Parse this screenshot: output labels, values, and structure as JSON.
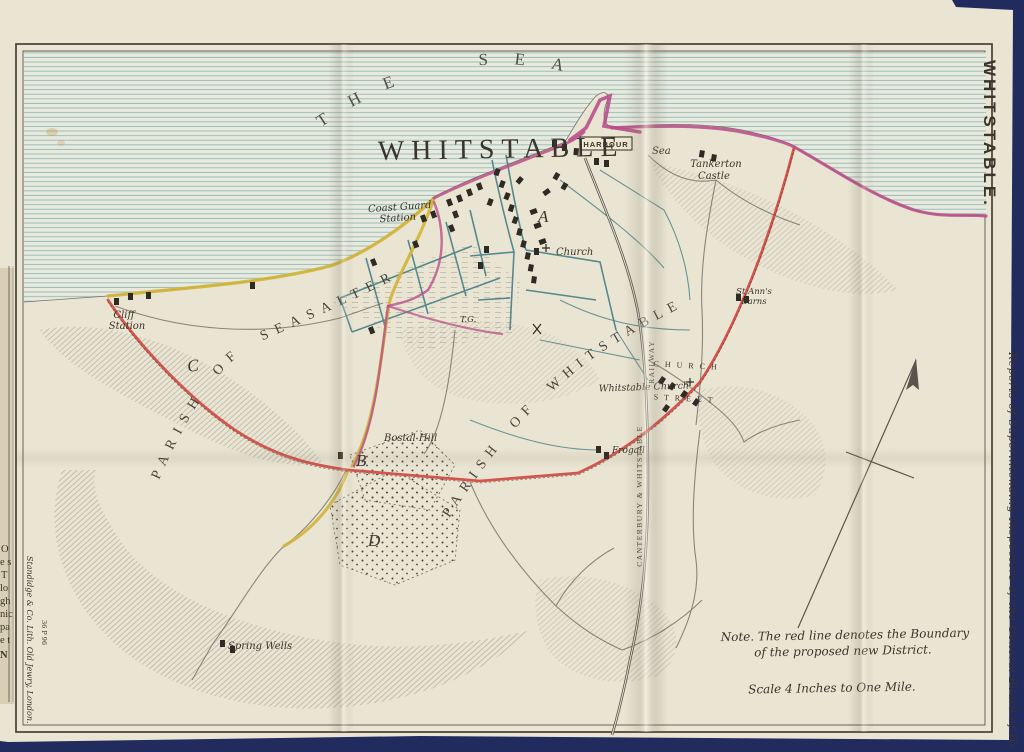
{
  "page": {
    "background_color": "#222b5e",
    "paper_color": "#eae5d3"
  },
  "margin": {
    "side_title": "WHITSTABLE.",
    "right_caption": "Reports of Superintending Inspectors of the General Board of Health.",
    "imprint": "Standidge & Co. Lith. Old Jewry, London.",
    "imprint_code": "36 P 96",
    "book_edge_fragments": [
      "O",
      "e s",
      "T",
      "lo",
      "gh",
      "nic",
      "pa",
      "e t",
      "N"
    ]
  },
  "map": {
    "sea_label": "THE  SEA",
    "title": "WHITSTABLE",
    "parish_seasalter": "PARISH OF SEASALTER",
    "parish_whitstable": "PARISH OF WHITSTABLE",
    "labels": {
      "harbour": "HARBOUR",
      "sea_small": "Sea",
      "tankerton_castle": [
        "Tankerton",
        "Castle"
      ],
      "coast_guard": [
        "Coast Guard",
        "Station"
      ],
      "cliff_station": [
        "Cliff",
        "Station"
      ],
      "church": "Church",
      "whitstable_church": "Whitstable Church",
      "church_street": [
        "C H U R C H",
        "S T R E E T"
      ],
      "st_anns": [
        "St Ann's",
        "Barns"
      ],
      "bostal_hill": "Bostal Hill",
      "spring_wells": "Spring Wells",
      "frogall": "Frogall",
      "tg": "T.G.",
      "railway_word": "RAILWAY",
      "railway_company": "CANTERBURY  &  WHITSTABLE",
      "marker_a": "A",
      "marker_b": "B",
      "marker_c": "C",
      "marker_d": "D"
    },
    "notes": {
      "note_line1": "Note.  The red line denotes the Boundary",
      "note_line2": "of the proposed new District.",
      "scale": "Scale  4  Inches to One Mile."
    },
    "colors": {
      "boundary_red": "#cf4a41",
      "road_yellow": "#d2b53c",
      "coast_pink": "#b8508a",
      "street_teal": "#477f87",
      "sea_line": "#94b9b5",
      "ink": "#3a352c"
    }
  }
}
